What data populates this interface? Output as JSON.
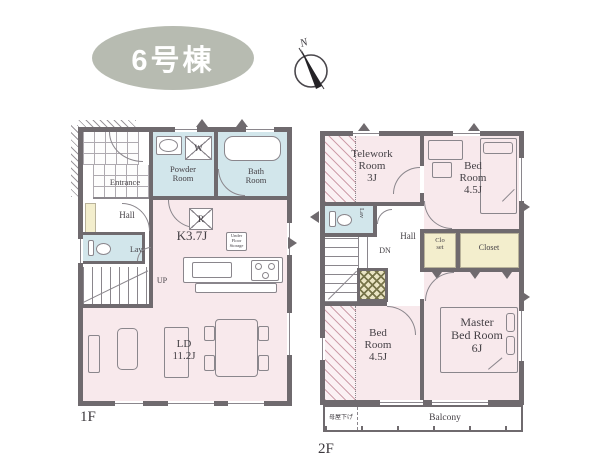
{
  "header": {
    "badge": "6号棟",
    "compass_n": "N"
  },
  "colors": {
    "room_pink": "#f8e9ec",
    "wet_blue": "#d2e6eb",
    "closet_cream": "#f3eecd",
    "wall_gray": "#6f6a6e",
    "badge_gray": "#b7bbb1",
    "void_hatch_olive": "#77744a"
  },
  "floor1": {
    "label": "1F",
    "entrance": "Entrance",
    "hall": "Hall",
    "lav": "Lav.",
    "powder_room": "Powder\nRoom",
    "bath_room": "Bath\nRoom",
    "washer": "W",
    "fridge": "R",
    "kitchen": "K3.7J",
    "under_floor": "Under\nFloor\nStorage",
    "up": "UP",
    "living": "LD\n11.2J"
  },
  "floor2": {
    "label": "2F",
    "telework": "Telework\nRoom\n3J",
    "lav": "Lav",
    "hall": "Hall",
    "dn": "DN",
    "bedroom_top": "Bed\nRoom\n4.5J",
    "closet_small": "Clo\nset",
    "closet": "Closet",
    "bedroom_bottom": "Bed\nRoom\n4.5J",
    "master": "Master\nBed Room\n6J",
    "balcony": "Balcony",
    "moya_sage": "母屋下げ"
  }
}
